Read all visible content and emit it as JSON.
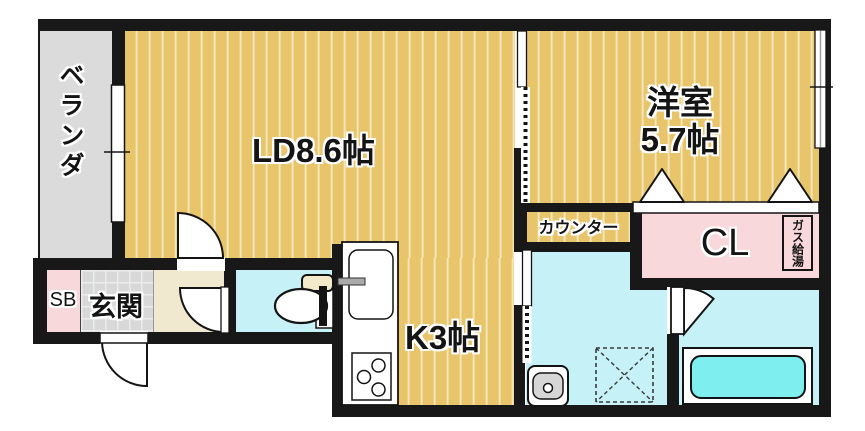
{
  "plan_title": "apartment-floor-plan",
  "rooms": {
    "veranda": {
      "label": "ベランダ"
    },
    "living_dining": {
      "label": "LD8.6帖"
    },
    "western_room": {
      "name": "洋室",
      "size": "5.7帖"
    },
    "kitchen": {
      "label": "K3帖"
    },
    "counter": {
      "label": "カウンター"
    },
    "closet": {
      "label": "CL"
    },
    "gas_water_heater": {
      "label": "ガス給湯"
    },
    "shoe_box": {
      "label": "SB"
    },
    "entrance": {
      "label": "玄関"
    }
  },
  "icons": [
    "window-icon",
    "sliding-door-icon",
    "hinged-door-icon",
    "folding-closet-door-icon",
    "toilet-icon",
    "kitchen-sink-icon",
    "gas-stove-icon",
    "washbasin-icon",
    "washing-machine-pan-icon",
    "bathtub-icon"
  ],
  "colors": {
    "wall": "#181818",
    "wood_floor": "#e8c46a",
    "wood_floor_stripe": "#f6edcf",
    "veranda_gray": "#dbdbdb",
    "wet_area_cyan": "#c6f1f7",
    "bathtub_cyan": "#7eeeee",
    "closet_pink": "#f9d8dc",
    "hall_beige": "#f1e8d0",
    "entrance_tile": "#d8d8d8"
  }
}
